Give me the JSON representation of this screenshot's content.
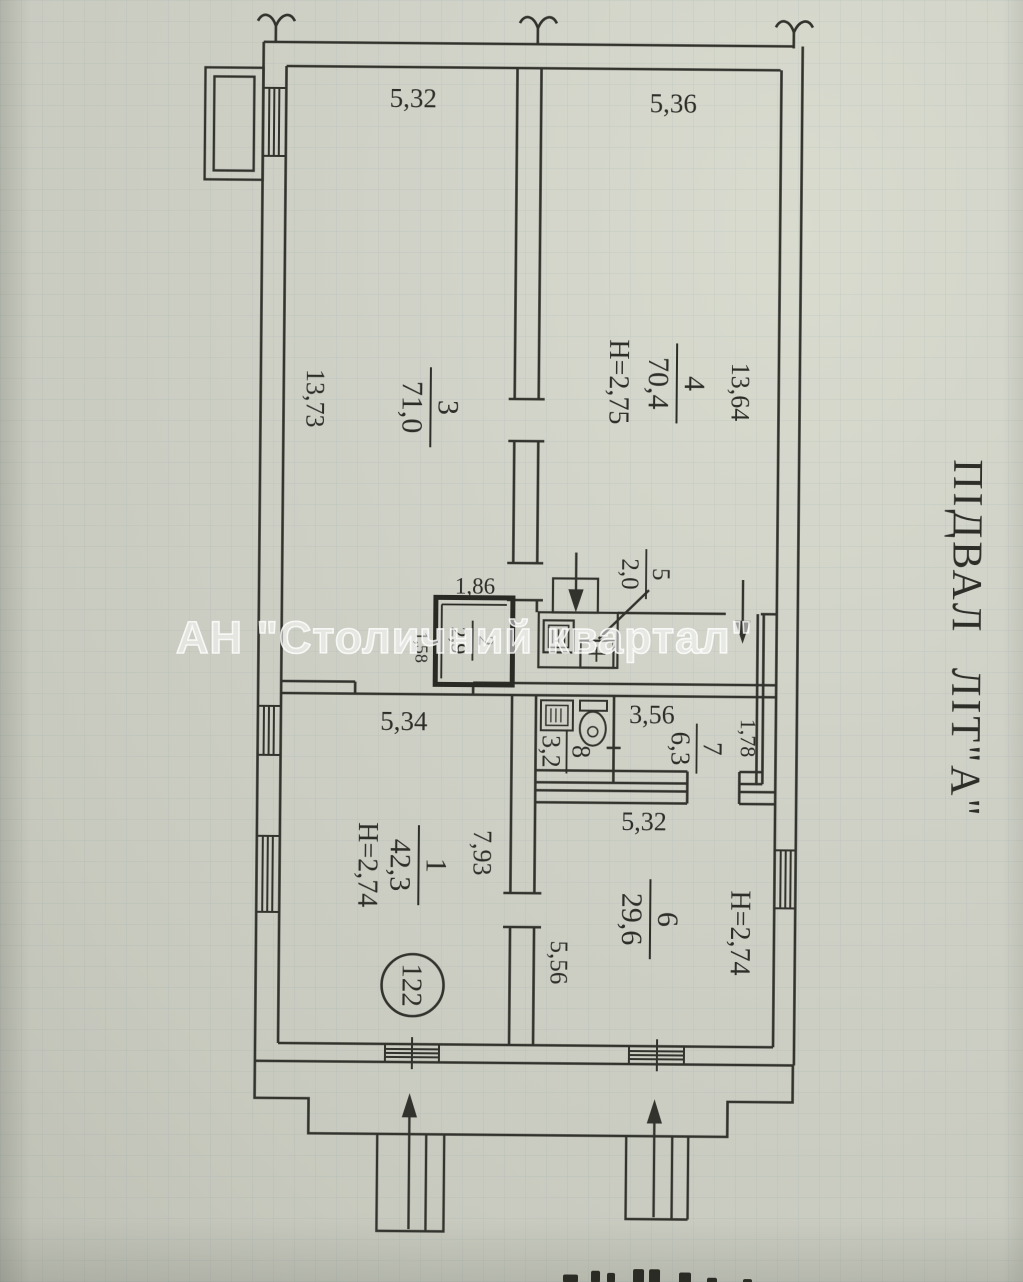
{
  "document": {
    "vertical_title": "ПІДВАЛ ЛІТ\"А\"",
    "watermark": "АН \"Столичний квартал\"",
    "unit_number": "122"
  },
  "rooms": {
    "r1": {
      "number": "1",
      "area": "42,3",
      "ceiling_height": "H=2,74",
      "dim_width": "5,34",
      "dim_depth": "7,93"
    },
    "r2": {
      "number": "2",
      "area": "2,9",
      "dim_width": "1,86",
      "dim_depth": "1,58"
    },
    "r3": {
      "number": "3",
      "area": "71,0",
      "dim_width": "5,32",
      "dim_depth": "13,73"
    },
    "r4": {
      "number": "4",
      "area": "70,4",
      "ceiling_height": "H=2,75",
      "dim_width": "5,36",
      "dim_depth": "13,64"
    },
    "r5": {
      "number": "5",
      "area": "2,0"
    },
    "r6": {
      "number": "6",
      "area": "29,6",
      "ceiling_height": "H=2,74",
      "dim_width": "5,32",
      "dim_depth": "5,56"
    },
    "r7": {
      "number": "7",
      "area": "6,3",
      "dim_width": "3,56",
      "dim_depth": "1,78"
    },
    "r8": {
      "number": "8",
      "area": "3,2"
    }
  }
}
